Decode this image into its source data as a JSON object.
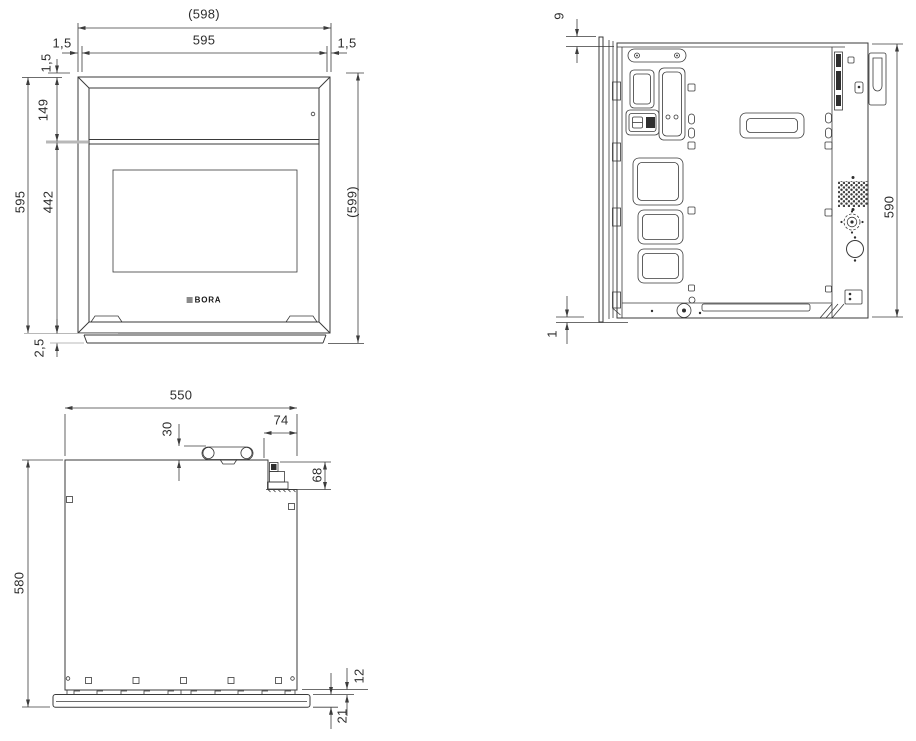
{
  "drawing_title": "BORA appliance dimensional drawing",
  "brand": "BORA",
  "front_view": {
    "dims": {
      "niche_width": "(598)",
      "width": "595",
      "gap_left": "1,5",
      "gap_right": "1,5",
      "gap_top": "1,5",
      "panel_height": "149",
      "height": "595",
      "door_height": "442",
      "overall_height": "(599)",
      "bottom_overhang": "2,5"
    }
  },
  "side_view": {
    "dims": {
      "door_top_offset": "9",
      "body_height": "590",
      "door_bottom_offset": "1"
    }
  },
  "top_view": {
    "dims": {
      "width": "550",
      "outlet_offset": "30",
      "connection_offset": "74",
      "connection_height": "68",
      "depth": "580",
      "front_gap": "12",
      "front_panel_thickness": "21"
    }
  },
  "colors": {
    "line": "#3a3a3a",
    "dim": "#3c3c3c",
    "light": "#b8b8b8",
    "background": "#ffffff",
    "logo": "#161616"
  }
}
